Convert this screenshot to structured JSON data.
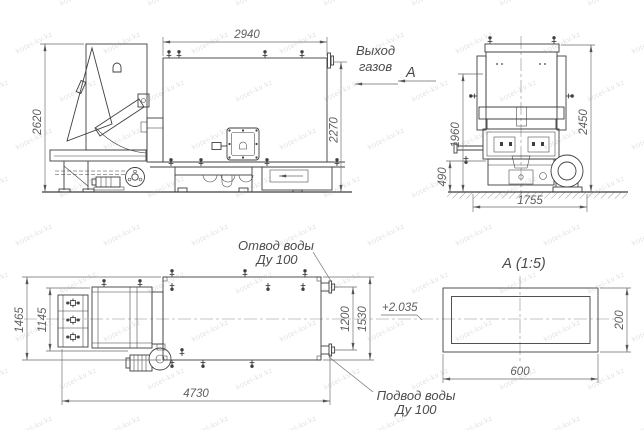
{
  "watermark": {
    "text": "kotel-kv.kz"
  },
  "side_view": {
    "dim_height_overall": "2620",
    "dim_width_top": "2940",
    "dim_height_right": "2270"
  },
  "gas_outlet": {
    "line1": "Выход",
    "line2": "газов"
  },
  "section_mark": {
    "label": "А"
  },
  "front_view": {
    "dim_height_inner": "1960",
    "dim_height_overall": "2450",
    "dim_base_height": "490",
    "dim_width": "1755"
  },
  "plan_view": {
    "dim_width_overall": "1465",
    "dim_width_inner": "1145",
    "dim_length": "4730",
    "dim_pipe_span": "1200",
    "dim_right_span": "1530",
    "elevation_mark": "+2.035",
    "water_outlet": {
      "line1": "Отвод воды",
      "line2": "Ду 100"
    },
    "water_inlet": {
      "line1": "Подвод воды",
      "line2": "Ду 100"
    }
  },
  "section_view": {
    "title": "А  (1:5)",
    "dim_width": "600",
    "dim_height": "200"
  }
}
